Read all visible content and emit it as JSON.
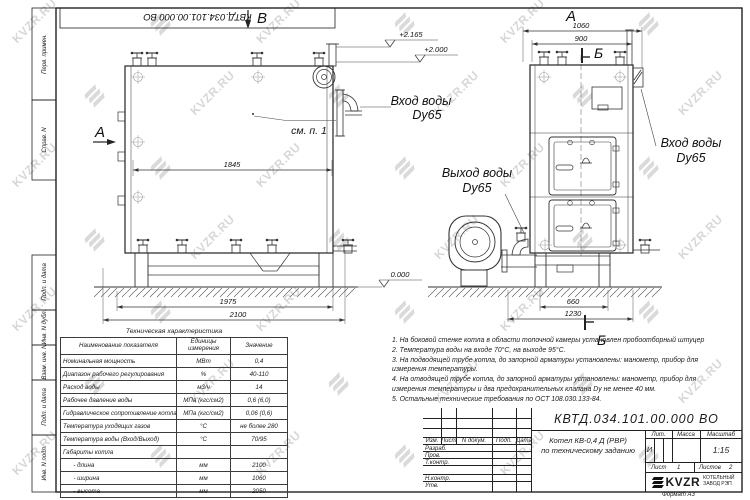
{
  "doc": {
    "number_stamp": "КВТД.034.101.00.000  ВО"
  },
  "frame_labels": {
    "perv": "Перв. примен.",
    "sprav": "Справ. N",
    "podp1": "Подп. и дата",
    "inv_dubl": "Инв. N дубл.",
    "vzam": "Взам. инв. N",
    "podp2": "Подп. и дата",
    "inv_podl": "Инв. N подл."
  },
  "drawing": {
    "labels": {
      "view_b": "В",
      "cut_a": "А",
      "view_a": "А",
      "cut_b_top": "Б",
      "cut_b_bottom": "Б",
      "see_note": "см. п. 1"
    },
    "ports": {
      "inlet_left_line1": "Вход воды",
      "inlet_left_line2": "Dy65",
      "inlet_right_line1": "Вход воды",
      "inlet_right_line2": "Dy65",
      "outlet_line1": "Выход воды",
      "outlet_line2": "Dy65"
    },
    "dims": {
      "d1845": "1845",
      "d1975": "1975",
      "d2100": "2100",
      "d1060": "1060",
      "d900": "900",
      "d660": "660",
      "d1230": "1230"
    },
    "levels": {
      "top": "+2.165",
      "mid": "+2.000",
      "zero": "0.000"
    }
  },
  "spec": {
    "title": "Техническая характеристика",
    "headers": [
      "Наименование показателя",
      "Единицы измерения",
      "Значение"
    ],
    "rows": [
      [
        "Номинальная мощность",
        "МВт",
        "0,4"
      ],
      [
        "Диапазон рабочего регулирования",
        "%",
        "40-110"
      ],
      [
        "Расход воды",
        "м3/ч",
        "14"
      ],
      [
        "Рабочее давление воды",
        "МПа (кгс/см2)",
        "0,6 (6,0)"
      ],
      [
        "Гидравлическое сопротивление котла",
        "МПа (кгс/см2)",
        "0,06 (0,6)"
      ],
      [
        "Температура уходящих газов",
        "°С",
        "не более 280"
      ],
      [
        "Температура воды (Вход/Выход)",
        "°С",
        "70/95"
      ],
      [
        "Габариты котла",
        "",
        ""
      ],
      [
        "      - длина",
        "мм",
        "2100"
      ],
      [
        "      - ширина",
        "мм",
        "1060"
      ],
      [
        "      - высота",
        "мм",
        "2050"
      ]
    ]
  },
  "notes": {
    "items": [
      "1.  На боковой стенке котла в области топочной камеры установлен пробоотборный штуцер",
      "2.  Температура воды на входе 70°С, на выходе 95°С.",
      "3.  На подводящей трубе котла, до запорной арматуры установлены: манометр, прибор для измерения температуры.",
      "4.  На отводящей трубе котла, до запорной арматуры установлены: манометр, прибор для измерения температуры и два предохранительных клапана  Dу не менее 40 мм.",
      "5.  Остальные технические требования по ОСТ 108.030.133-84."
    ]
  },
  "title_block": {
    "designation": "КВТД.034.101.00.000  ВО",
    "product_line1": "Котел  КВ-0,4 Д (РВР)",
    "product_line2": "по техническому заданию",
    "cols": {
      "izm": "Изм.",
      "list": "Лист",
      "ndoc": "N докум.",
      "podp": "Подп.",
      "data": "Дата"
    },
    "rows": {
      "razrab": "Разраб.",
      "prov": "Пров.",
      "tkontr": "Т.контр.",
      "nkontr": "Н.контр.",
      "utv": "Утв."
    },
    "lit_label": "Лит.",
    "lit_value": "И",
    "mass_label": "Масса",
    "scale_label": "Масштаб",
    "scale_value": "1:15",
    "sheet_label": "Лист",
    "sheet_value": "1",
    "sheets_label": "Листов",
    "sheets_value": "2",
    "company_name": "KVZR",
    "company_line1": "КОТЕЛЬНЫЙ",
    "company_line2": "ЗАВОД РЭП",
    "format": "Формат  А3"
  },
  "watermark": {
    "text": "KVZR.RU"
  }
}
